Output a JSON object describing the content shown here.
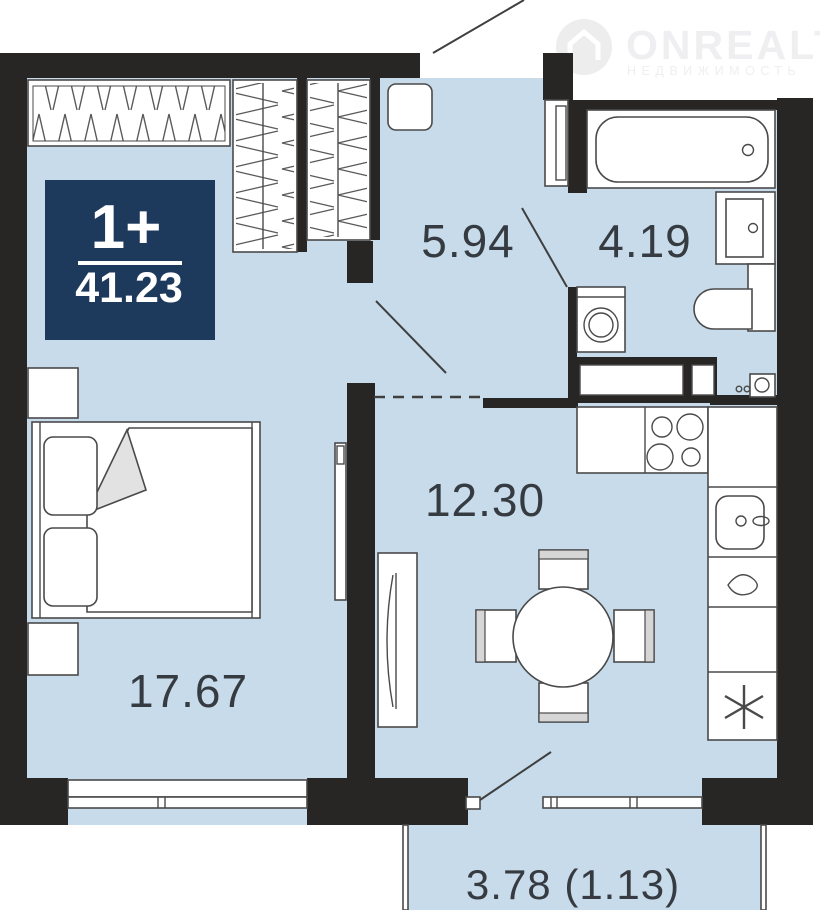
{
  "page": {
    "width": 820,
    "height": 910
  },
  "watermark": {
    "brand": "ONREALT",
    "tagline": "НЕДВИЖИМОСТЬ"
  },
  "info_badge": {
    "layout_type": "1+",
    "total_area": "41.23"
  },
  "rooms": {
    "hallway": {
      "area": "5.94"
    },
    "bathroom": {
      "area": "4.19"
    },
    "kitchen_living_room": {
      "area": "12.30"
    },
    "bedroom": {
      "area": "17.67"
    },
    "balcony": {
      "area": "3.78 (1.13)"
    }
  },
  "colors": {
    "wall": "#282525",
    "floor": "#c7dbea",
    "badge_bg": "#1d3a5c",
    "badge_text": "#ffffff",
    "label_text": "#363b42",
    "furniture_line": "#4a4a4a",
    "furniture_fill": "#ffffff",
    "blanket_fold": "#e2e2e2",
    "chair_accent": "#d6d6d6",
    "watermark": "#efeef0"
  }
}
